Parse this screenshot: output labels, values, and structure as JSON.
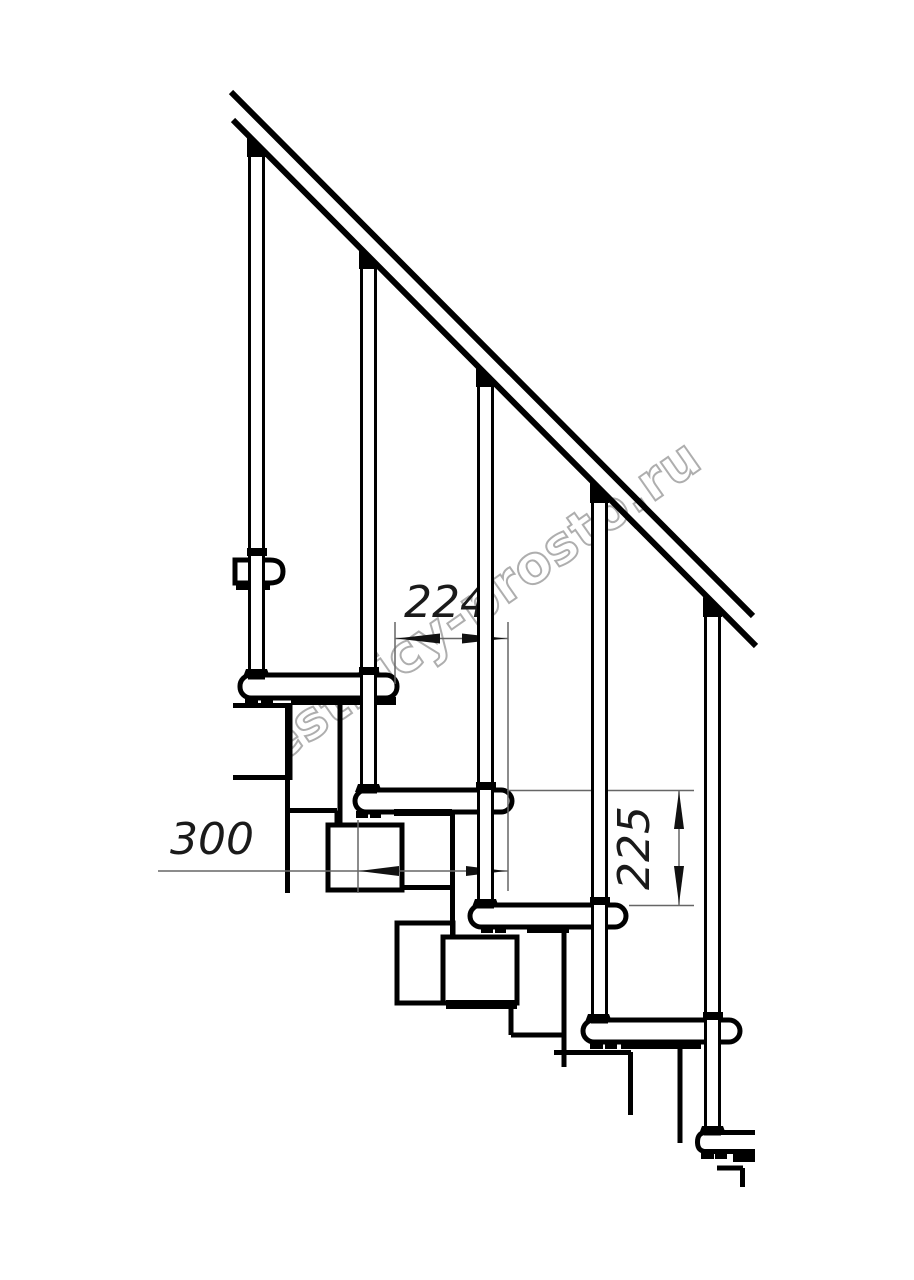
{
  "drawing": {
    "title": "modular staircase side view technical drawing",
    "dimensions": {
      "tread_depth": "300",
      "step_going": "224",
      "step_rise": "225"
    },
    "watermark": "lestnicy-prosto.ru"
  },
  "colors": {
    "line": "#000000",
    "dimension_line": "#666666",
    "dimension_text": "#1a1a1a",
    "watermark": "#9b9b9b",
    "background": "#ffffff"
  }
}
